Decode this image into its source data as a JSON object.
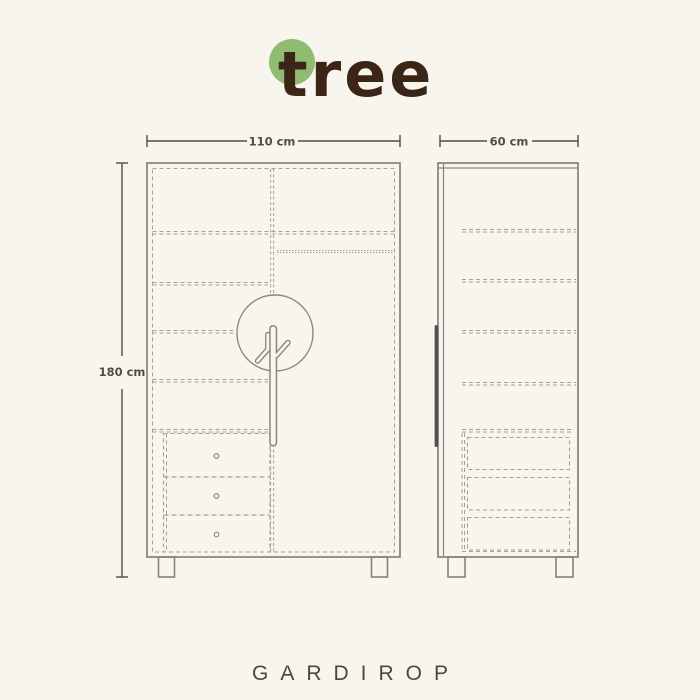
{
  "brand": {
    "logo_text": "tree",
    "logo_dot_color": "#8fbb72",
    "logo_text_color": "#3b2516"
  },
  "product_title": "GARDIROP",
  "dimensions": {
    "width": "110 cm",
    "depth": "60 cm",
    "height": "180 cm"
  },
  "colors": {
    "background": "#f8f5ef",
    "outline": "#85827b",
    "dashed_line": "#a3a099",
    "dimension_text": "#4f4d47",
    "side_handle_bar": "#55524d",
    "title_text": "#4b4841"
  }
}
